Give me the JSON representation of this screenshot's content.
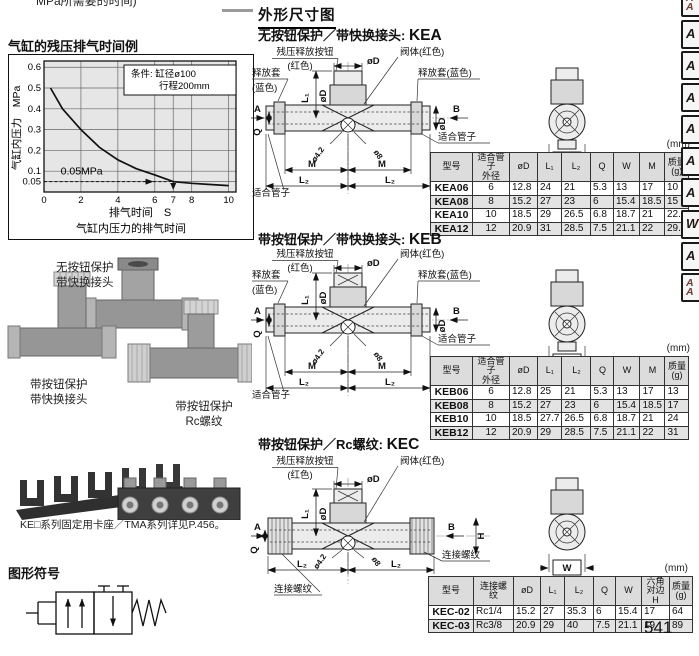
{
  "colors": {
    "plot_bg": "#e6e6e6",
    "table_header_bg": "#dcdcdc",
    "row_shade": "#e3e3e3",
    "line": "#111111"
  },
  "page": {
    "top_cut_text": "MPa所需要的时间)",
    "page_number": "541"
  },
  "tabs": [
    [
      "A",
      "A"
    ],
    [
      "A"
    ],
    [
      "A"
    ],
    [
      "A"
    ],
    [
      "A"
    ],
    [
      "A"
    ],
    [
      "A"
    ],
    [
      "W"
    ],
    [
      "A"
    ],
    [
      "A",
      "A"
    ]
  ],
  "left": {
    "chart_heading": "气缸的残压排气时间例",
    "photos": {
      "label_top": [
        "无按钮保护",
        "带快换接头"
      ],
      "label_bottom_left": [
        "带按钮保护",
        "带快换接头"
      ],
      "label_bottom_right": [
        "带按钮保护",
        "Rc螺纹"
      ]
    },
    "caption": "KE□系列固定用卡座／TMA系列详见P.456。",
    "symbol_heading": "图形符号"
  },
  "chart_data": {
    "type": "line",
    "title": "气缸的残压排气时间例",
    "condition_lines": [
      "条件: 缸径ø100",
      "行程200mm"
    ],
    "xlabel": "排气时间　S",
    "caption": "气缸内压力的排气时间",
    "ylabel": "气缸内压力　MPa",
    "x_ticks": [
      0,
      2,
      4,
      6,
      7,
      8,
      10
    ],
    "y_ticks": [
      0.05,
      0.1,
      0.2,
      0.3,
      0.4,
      0.5,
      0.6
    ],
    "xlim": [
      0,
      10.4
    ],
    "ylim": [
      0,
      0.63
    ],
    "annotation": "0.05MPa",
    "guide": {
      "y": 0.05,
      "x_end": 7
    },
    "grid": true,
    "legend": "none",
    "series": [
      {
        "name": "残压排气曲线",
        "x": [
          0.35,
          1,
          2,
          3,
          4,
          5,
          6,
          7,
          8,
          9,
          10
        ],
        "y": [
          0.5,
          0.4,
          0.3,
          0.215,
          0.155,
          0.112,
          0.082,
          0.05,
          0.042,
          0.036,
          0.031
        ]
      }
    ]
  },
  "right": {
    "heading": "外形尺寸图",
    "sections": [
      {
        "title": "无按钮保护／带快换接头: ",
        "model": "KEA",
        "units": "(mm)",
        "labels": {
          "button1": "残压释放按钮",
          "button2": "(红色)",
          "body": "阀体(红色)",
          "sleeve_l1": "释放套",
          "sleeve_l2": "(蓝色)",
          "sleeve_r": "释放套(蓝色)",
          "tube_l": "适合管子",
          "tube_r": "适合管子",
          "dim_d_top": "øD",
          "dim_d_stack": "øD",
          "dim_d_right": "øD",
          "dim_l1": "L₁",
          "dim_l2a": "L₂",
          "dim_l2b": "L₂",
          "dim_ma": "M",
          "dim_mb": "M",
          "dim_q": "Q",
          "dim_a": "A",
          "dim_b": "B",
          "dim_w": "W",
          "hole_small": "ø4.2",
          "hole_big": "ø8"
        },
        "table": {
          "headers": [
            "型号",
            "适合管子\n外径",
            "øD",
            "L₁",
            "L₂",
            "Q",
            "W",
            "M",
            "质量\n(g)"
          ],
          "rows": [
            [
              "KEA06",
              "6",
              "12.8",
              "24",
              "21",
              "5.3",
              "13",
              "17",
              "10"
            ],
            [
              "KEA08",
              "8",
              "15.2",
              "27",
              "23",
              "6",
              "15.4",
              "18.5",
              "15"
            ],
            [
              "KEA10",
              "10",
              "18.5",
              "29",
              "26.5",
              "6.8",
              "18.7",
              "21",
              "22.5"
            ],
            [
              "KEA12",
              "12",
              "20.9",
              "31",
              "28.5",
              "7.5",
              "21.1",
              "22",
              "29.5"
            ]
          ]
        }
      },
      {
        "title": "带按钮保护／带快换接头: ",
        "model": "KEB",
        "units": "(mm)",
        "labels": {
          "button1": "残压释放按钮",
          "button2": "(红色)",
          "body": "阀体(红色)",
          "sleeve_l1": "释放套",
          "sleeve_l2": "(蓝色)",
          "sleeve_r": "释放套(蓝色)",
          "tube_l": "适合管子",
          "tube_r": "适合管子",
          "dim_d_top": "øD",
          "dim_d_stack": "øD",
          "dim_d_right": "øD",
          "dim_l1": "L₁",
          "dim_l2a": "L₂",
          "dim_l2b": "L₂",
          "dim_ma": "M",
          "dim_mb": "M",
          "dim_q": "Q",
          "dim_a": "A",
          "dim_b": "B",
          "dim_w": "W",
          "hole_small": "ø4.2",
          "hole_big": "ø8"
        },
        "table": {
          "headers": [
            "型号",
            "适合管子\n外径",
            "øD",
            "L₁",
            "L₂",
            "Q",
            "W",
            "M",
            "质量\n(g)"
          ],
          "rows": [
            [
              "KEB06",
              "6",
              "12.8",
              "25",
              "21",
              "5.3",
              "13",
              "17",
              "13"
            ],
            [
              "KEB08",
              "8",
              "15.2",
              "27",
              "23",
              "6",
              "15.4",
              "18.5",
              "17"
            ],
            [
              "KEB10",
              "10",
              "18.5",
              "27.7",
              "26.5",
              "6.8",
              "18.7",
              "21",
              "24"
            ],
            [
              "KEB12",
              "12",
              "20.9",
              "29",
              "28.5",
              "7.5",
              "21.1",
              "22",
              "31"
            ]
          ]
        }
      },
      {
        "title": "带按钮保护／Rc螺纹: ",
        "model": "KEC",
        "units": "(mm)",
        "labels": {
          "button1": "残压释放按钮",
          "button2": "(红色)",
          "body": "阀体(红色)",
          "thread_r": "连接螺纹",
          "thread_l": "连接螺纹",
          "dim_d_top": "øD",
          "dim_d_stack": "øD",
          "dim_l1": "L₁",
          "dim_l2a": "L₂",
          "dim_l2b": "L₂",
          "dim_q": "Q",
          "dim_a": "A",
          "dim_b": "B",
          "dim_h": "H",
          "dim_w": "W",
          "hole_small": "ø4.2",
          "hole_big": "ø8"
        },
        "table": {
          "align1": "left",
          "headers": [
            "型号",
            "连接螺纹",
            "øD",
            "L₁",
            "L₂",
            "Q",
            "W",
            "六角对边\nH",
            "质量\n(g)"
          ],
          "rows": [
            [
              "KEC-02",
              "Rc1/4",
              "15.2",
              "27",
              "35.3",
              "6",
              "15.4",
              "17",
              "64"
            ],
            [
              "KEC-03",
              "Rc3/8",
              "20.9",
              "29",
              "40",
              "7.5",
              "21.1",
              "19",
              "89"
            ]
          ]
        }
      }
    ]
  }
}
